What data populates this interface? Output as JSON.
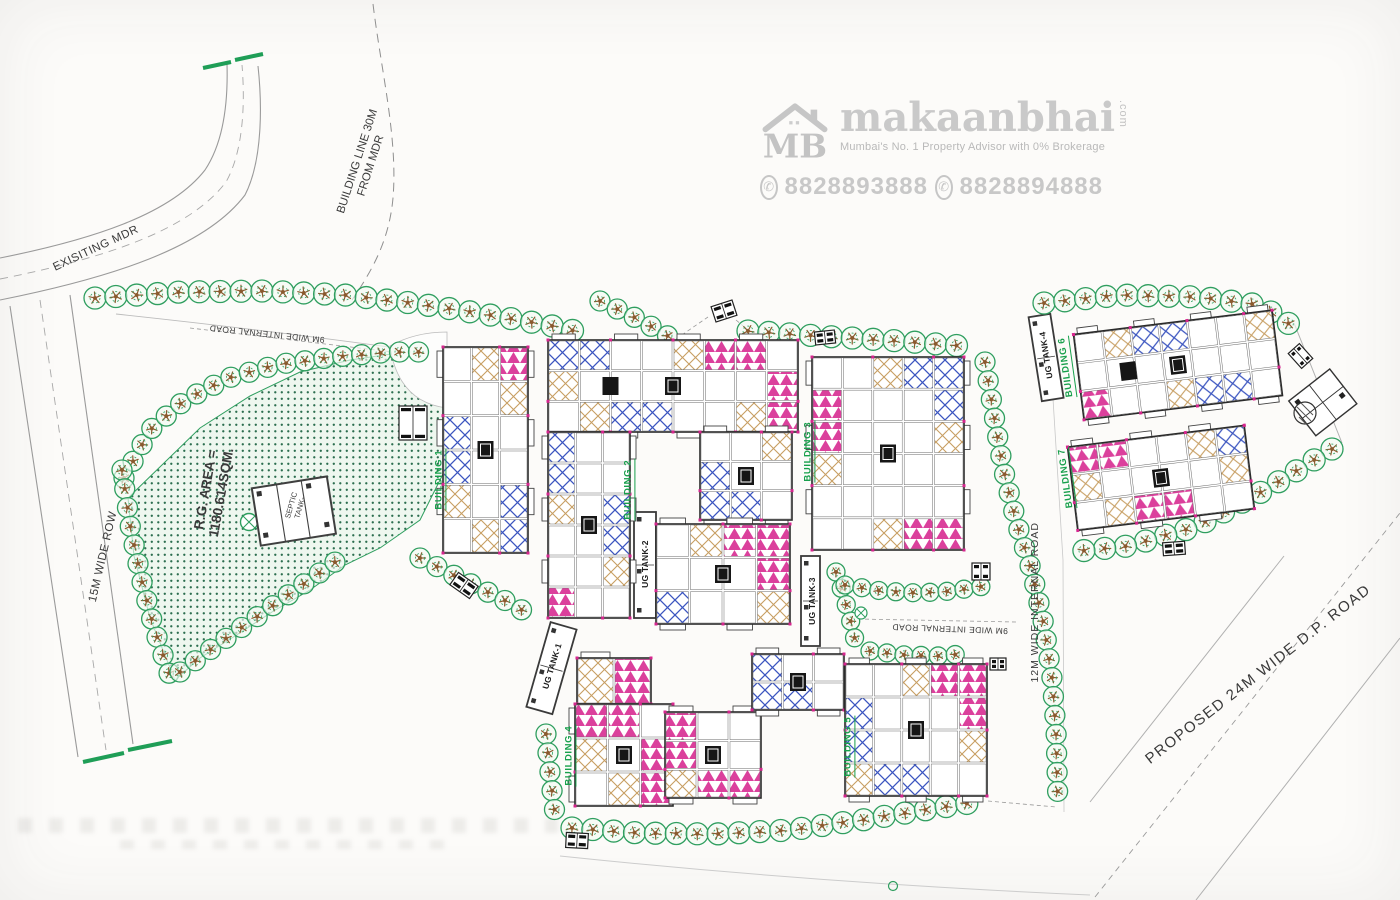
{
  "watermark": {
    "logo_text": "MB",
    "brand": "makaanbhai",
    "brand_suffix": ".com",
    "tagline": "Mumbai's No. 1 Property Advisor with 0% Brokerage",
    "phone1": "8828893888",
    "phone2": "8828894888"
  },
  "roads": {
    "existing_mdr": "EXISITING MDR",
    "building_line_1": "BUILDING LINE 30M",
    "building_line_2": "FROM MDR",
    "row_15m": "15M WIDE ROW",
    "internal_9m_top": "9M WIDE INTERNAL ROAD",
    "internal_9m_bottom": "9M WIDE INTERNAL ROAD",
    "internal_12m": "12M WIDE INTERNAL ROAD",
    "dp_24m": "PROPOSED 24M WIDE D.P. ROAD"
  },
  "site": {
    "rg_area_line1": "R.G. AREA =",
    "rg_area_line2": "1180.614SQM.",
    "septic_line1": "SEPTIC",
    "septic_line2": "TANK-"
  },
  "buildings": [
    {
      "label": "BUILDING 1"
    },
    {
      "label": "BUILDING 2"
    },
    {
      "label": "BUILDING 3"
    },
    {
      "label": "BUILDING 4"
    },
    {
      "label": "BUILDING 5"
    },
    {
      "label": "BUILDING 6"
    },
    {
      "label": "BUILDING 7"
    }
  ],
  "tanks": [
    {
      "label": "UG TANK-1"
    },
    {
      "label": "UG TANK-2"
    },
    {
      "label": "UG TANK-3"
    },
    {
      "label": "UG TANK-4"
    }
  ],
  "colors": {
    "tree_green": "#2f9e5f",
    "plan_pink": "#d6258e",
    "plan_blue": "#3b55c0",
    "plan_tan": "#c79e62",
    "label_green": "#18a04c",
    "rg_dot": "#2c6e4f",
    "watermark_gray": "#c6c6c6"
  }
}
